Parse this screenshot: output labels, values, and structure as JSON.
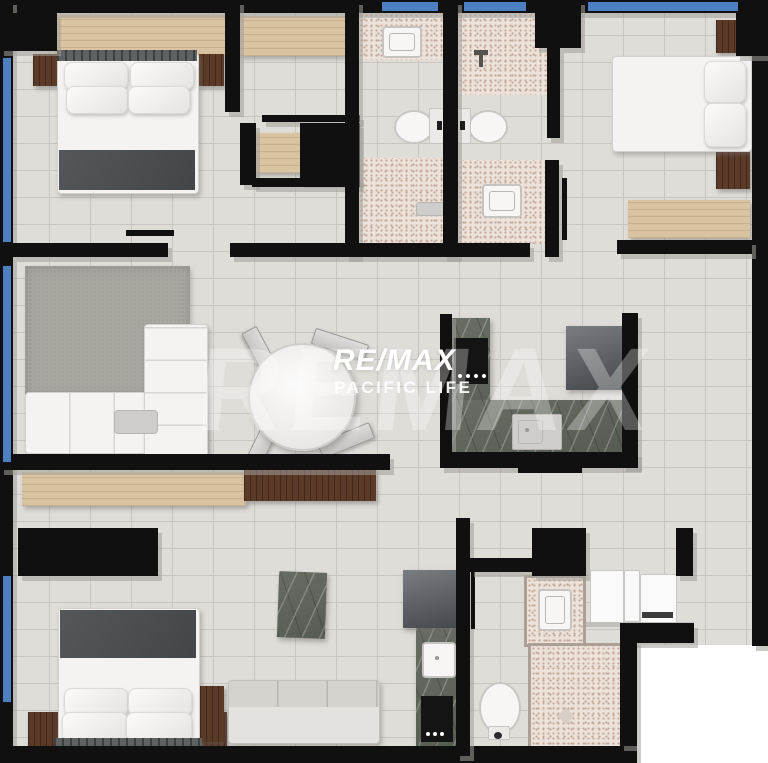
{
  "watermark": {
    "ghost_text": "REMAX",
    "brand": "RE/MAX",
    "tagline": "PACIFIC LIFE"
  },
  "colors": {
    "wall": "#101010",
    "floor": "#dfddd8",
    "grout": "#c9c6c1",
    "window": "#4d80c3",
    "wood_light": "#d9c3a0",
    "wood_dark": "#5c3a28",
    "speckle_base": "#ece2da",
    "speckle_dot": "#c3aa9b",
    "marble_dark": "#575c53",
    "rug": "#a9a7a0",
    "white_furn": "#f4f3f1",
    "watermark_white": "#ffffff"
  }
}
